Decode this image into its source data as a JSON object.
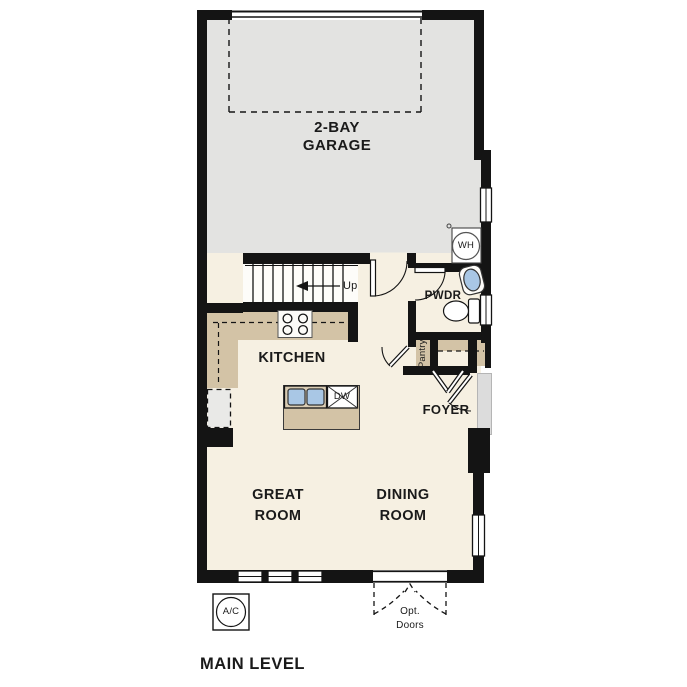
{
  "title": "MAIN LEVEL",
  "rooms": {
    "garage": {
      "line1": "2-BAY",
      "line2": "GARAGE"
    },
    "kitchen": {
      "label": "KITCHEN"
    },
    "great_room": {
      "line1": "GREAT",
      "line2": "ROOM"
    },
    "dining_room": {
      "line1": "DINING",
      "line2": "ROOM"
    },
    "foyer": {
      "label": "FOYER"
    },
    "powder_room": {
      "label": "PWDR"
    },
    "pantry": {
      "label": "Pantry"
    }
  },
  "fixtures": {
    "water_heater": "WH",
    "dishwasher": "DW",
    "ac_unit": "A/C",
    "stairs_direction": "Up",
    "optional_doors": {
      "line1": "Opt.",
      "line2": "Doors"
    }
  },
  "colors": {
    "wall": "#141414",
    "garage_floor": "#e3e3e1",
    "living_floor": "#f6f0e2",
    "counter_tan": "#d3c3a6",
    "sink_blue": "#a9c7e5",
    "porch_gray": "#dcdcdc"
  }
}
